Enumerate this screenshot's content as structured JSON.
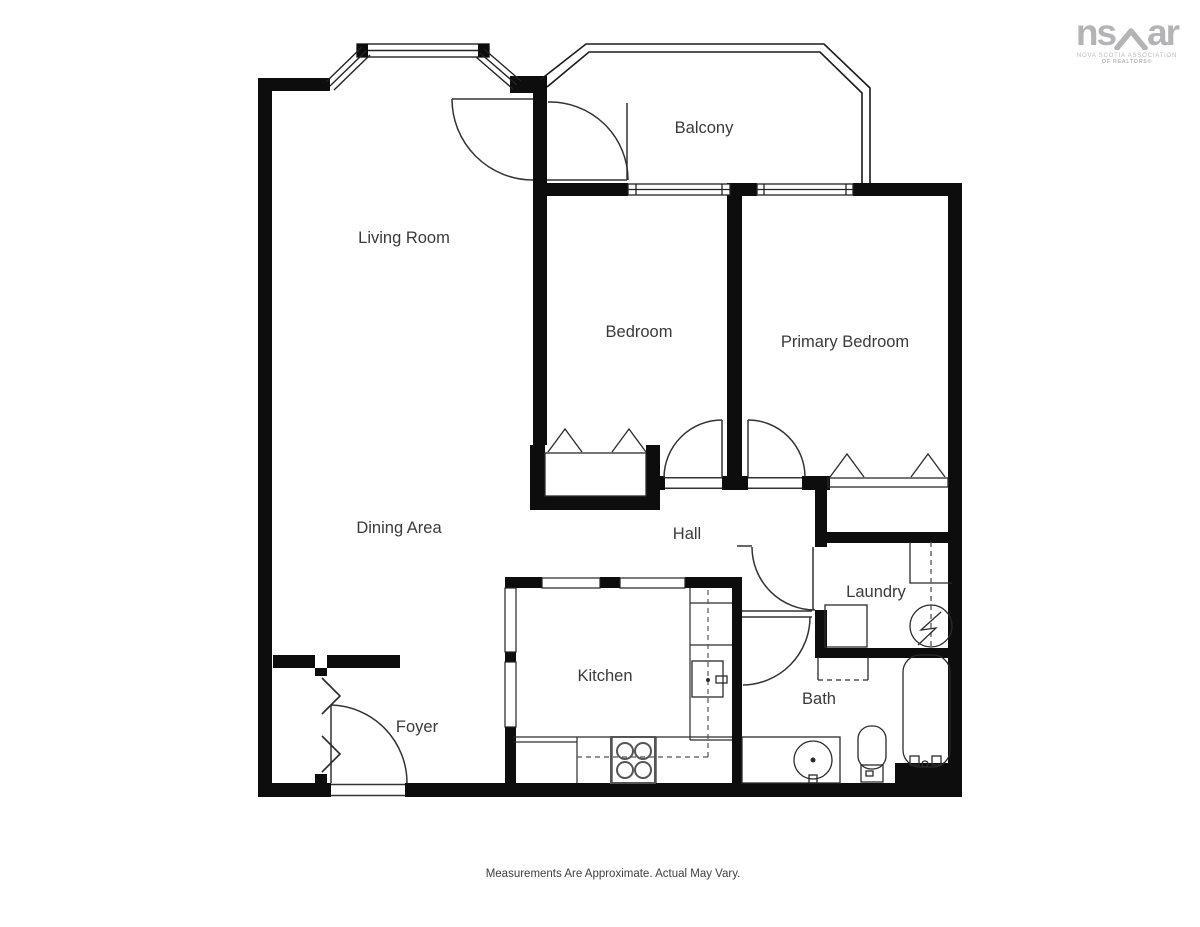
{
  "colors": {
    "wall": "#0d0d0d",
    "line": "#222222",
    "door": "#333333",
    "fixture": "#555555",
    "label": "#3a3a3a",
    "logo_gray": "#b4b4b6"
  },
  "rooms": {
    "balcony": "Balcony",
    "living_room": "Living Room",
    "bedroom": "Bedroom",
    "primary_bedroom": "Primary Bedroom",
    "dining_area": "Dining Area",
    "hall": "Hall",
    "laundry": "Laundry",
    "kitchen": "Kitchen",
    "bath": "Bath",
    "foyer": "Foyer"
  },
  "icons": {
    "washer": "washer-icon",
    "stove": "stove-icon",
    "dishwasher": "dishwasher-icon",
    "sink": "sink-icon",
    "toilet": "toilet-icon",
    "bathtub": "bathtub-icon"
  },
  "logo": {
    "prefix": "ns",
    "suffix": "ar",
    "line1": "NOVA SCOTIA ASSOCIATION",
    "line2": "OF REALTORS®"
  },
  "footer": {
    "disclaimer": "Measurements Are Approximate. Actual May Vary."
  }
}
